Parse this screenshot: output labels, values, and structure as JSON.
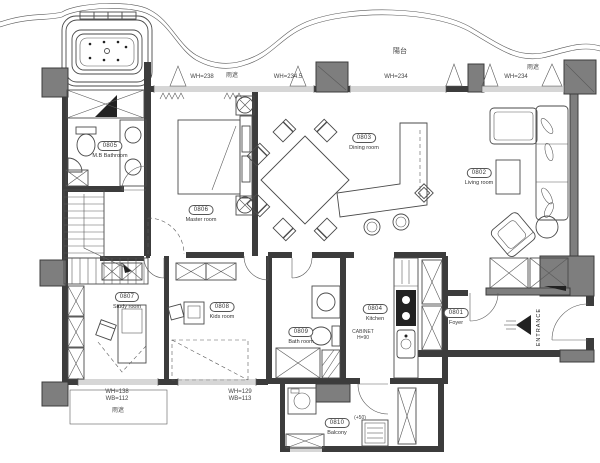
{
  "plan": {
    "rooms": [
      {
        "id": "0801",
        "name": "Foyer"
      },
      {
        "id": "0802",
        "name": "Living room"
      },
      {
        "id": "0803",
        "name": "Dining room"
      },
      {
        "id": "0804",
        "name": "Kitchen"
      },
      {
        "id": "0805",
        "name": "M.B Bathroom"
      },
      {
        "id": "0806",
        "name": "Master room"
      },
      {
        "id": "0807",
        "name": "Study room"
      },
      {
        "id": "0808",
        "name": "Kids room"
      },
      {
        "id": "0809",
        "name": "Bath room"
      },
      {
        "id": "0810",
        "name": "Balcony"
      }
    ],
    "windows_top": [
      {
        "label": "WH=238"
      },
      {
        "label": "WH=234.5"
      },
      {
        "label": "WH=234"
      },
      {
        "label": "WH=234"
      }
    ],
    "windows_bottom": [
      {
        "line1": "WH=138",
        "line2": "WB=112"
      },
      {
        "line1": "WH=129",
        "line2": "WB=113"
      }
    ],
    "annotations": {
      "balcony": "陽台",
      "rain_cover_left": "雨遮",
      "rain_cover_right": "雨遮",
      "rain_cover_bottom": "雨遮",
      "entrance": "ENTRANCE",
      "cabinet_line1": "CABINET",
      "cabinet_line2": "H=90",
      "floor_level": "(+50)"
    }
  }
}
